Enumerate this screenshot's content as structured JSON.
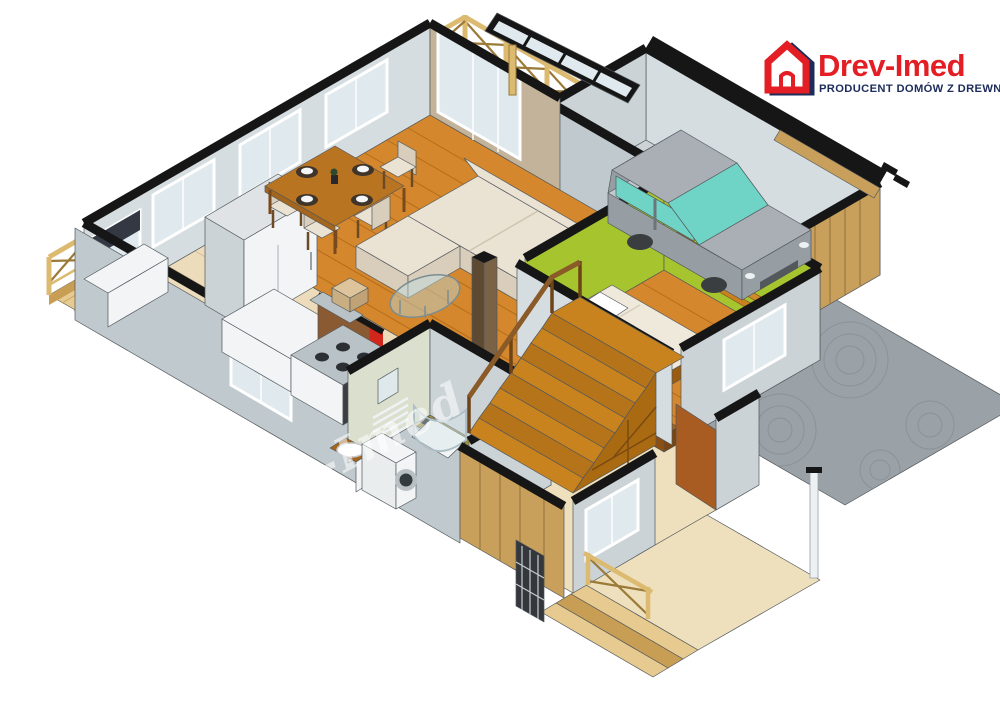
{
  "canvas": {
    "width": 1000,
    "height": 724,
    "background": "#ffffff"
  },
  "logo": {
    "brand": "Drev-Imed",
    "tagline": "PRODUCENT DOMÓW Z DREWNA",
    "icon": "house-outline-icon",
    "brand_color": "#e31e25",
    "tagline_color": "#1d2c5b"
  },
  "watermark": {
    "text": "Drev-Imed"
  },
  "palette": {
    "bg": "#ffffff",
    "edge": "#51575b",
    "cap": "#161616",
    "wall_light": "#d6dde0",
    "wall_mid": "#cbd3d7",
    "wall_dark": "#c0c9cd",
    "wall_green_tint": "#dadfce",
    "tan_wall": "#c2b39a",
    "wood_floor": "#d4872c",
    "wood_line": "#b46d1a",
    "deck": "#e7ca90",
    "deck_line": "#c9a55c",
    "deck_edge": "#c89e54",
    "tile_kitchen": "#eddcbb",
    "tile_line": "#d5bf9b",
    "tile_bath": "#a3913e",
    "tile_bath_line": "#857530",
    "hall_floor": "#eedfbd",
    "green_wall": "#a6c42e",
    "garage_floor": "#ccd2d5",
    "car_body": "#a9afb4",
    "car_body2": "#979ea3",
    "car_glass": "#6fd4c6",
    "car_dark": "#53585c",
    "sofa": "#eae2d3",
    "sofa_dark": "#d8cebb",
    "red_accent": "#d2261c",
    "stair_wood": "#c8831f",
    "stair_wood2": "#b5731a",
    "under_stair": "#a96a12",
    "rail_wood": "#dcba70",
    "rail_dark": "#9a7a36",
    "door_brown": "#a85c22",
    "wood_wall": "#c8a05c",
    "wood_wall_line": "#9a7a40",
    "glass": "#dfe9ee",
    "white_detail": "#f2f4f5",
    "curtain": "#343842",
    "oven_dark": "#3a3e41",
    "driveway": "#9ba2a7",
    "driveway_line": "#868d92",
    "logo_red": "#e31e25",
    "logo_navy": "#1d2c5b",
    "watermark": "rgba(255,255,255,0.55)"
  },
  "scene": {
    "type": "isometric-3d-cutaway-floor-plan",
    "style": "SketchUp-like architectural render of a single-storey wooden house",
    "rooms": [
      {
        "name": "living-dining-room",
        "floor": "wood-planks",
        "items": [
          "corner-sofa",
          "ottoman-pouf",
          "glass-coffee-table",
          "decor-column",
          "dining-table",
          "dining-chairs-x4",
          "table-settings-x4",
          "vase"
        ]
      },
      {
        "name": "kitchen",
        "floor": "beige-tiles",
        "items": [
          "fridge",
          "corner-counter",
          "corner-window-with-curtains",
          "white-worktop",
          "stove-with-oven",
          "cooker-hood",
          "wood-partition-wall",
          "red-accent-panel"
        ]
      },
      {
        "name": "bathroom",
        "floor": "olive-tiles",
        "items": [
          "washing-machine",
          "sink-cabinet",
          "corner-shower",
          "towel-radiator",
          "mirror"
        ]
      },
      {
        "name": "bedroom",
        "walls": "green",
        "floor": "wood-planks",
        "items": [
          "bed",
          "chevron-wall-shelves",
          "bedside-cabinet",
          "window"
        ]
      },
      {
        "name": "garage",
        "floor": "concrete",
        "items": [
          "car-minivan",
          "wooden-garage-door"
        ]
      },
      {
        "name": "hallway-entrance",
        "floor": "beige-tiles",
        "items": [
          "winder-staircase",
          "stair-handrail",
          "under-stair-shelving",
          "interior-door",
          "entry-window"
        ]
      },
      {
        "name": "terrace",
        "floor": "wood-deck",
        "items": [
          "cross-braced-railing",
          "glass-canopy-pergola",
          "pergola-post"
        ]
      },
      {
        "name": "porch",
        "floor": "beige-tiles",
        "items": [
          "entry-steps",
          "porch-railing",
          "glazed-front-door",
          "white-post",
          "wood-clad-wall"
        ]
      },
      {
        "name": "driveway",
        "surface": "paved-fan-pattern"
      }
    ]
  }
}
